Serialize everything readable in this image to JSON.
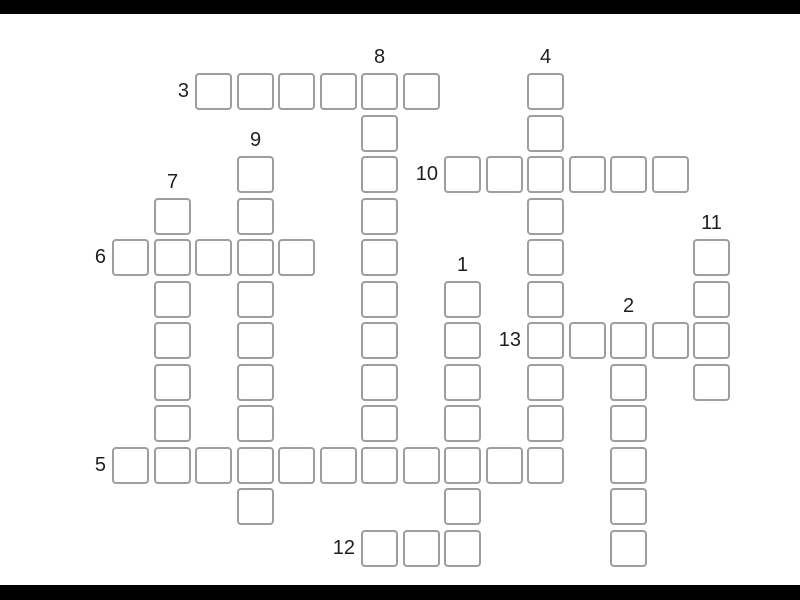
{
  "app": {
    "background_color": "#ffffff",
    "letterbox_color": "#000000"
  },
  "puzzle": {
    "type": "crossword-grid-empty",
    "cell_border_color": "#9e9e9e",
    "cell_fill_color": "#ffffff",
    "label_color": "#1f1f1f",
    "clue_numbers": [
      "1",
      "2",
      "3",
      "4",
      "5",
      "6",
      "7",
      "8",
      "9",
      "10",
      "11",
      "12",
      "13"
    ],
    "entries": [
      {
        "number": "3",
        "direction": "across",
        "row": 0,
        "col": 2,
        "length": 6
      },
      {
        "number": "8",
        "direction": "down",
        "row": 0,
        "col": 6,
        "length": 10
      },
      {
        "number": "4",
        "direction": "down",
        "row": 0,
        "col": 10,
        "length": 10
      },
      {
        "number": "9",
        "direction": "down",
        "row": 2,
        "col": 3,
        "length": 9
      },
      {
        "number": "10",
        "direction": "across",
        "row": 2,
        "col": 8,
        "length": 6
      },
      {
        "number": "7",
        "direction": "down",
        "row": 3,
        "col": 1,
        "length": 7
      },
      {
        "number": "6",
        "direction": "across",
        "row": 4,
        "col": 0,
        "length": 5
      },
      {
        "number": "11",
        "direction": "down",
        "row": 4,
        "col": 14,
        "length": 4
      },
      {
        "number": "1",
        "direction": "down",
        "row": 5,
        "col": 8,
        "length": 7
      },
      {
        "number": "13",
        "direction": "across",
        "row": 6,
        "col": 10,
        "length": 5
      },
      {
        "number": "2",
        "direction": "down",
        "row": 6,
        "col": 12,
        "length": 6
      },
      {
        "number": "5",
        "direction": "across",
        "row": 9,
        "col": 0,
        "length": 11
      },
      {
        "number": "12",
        "direction": "across",
        "row": 11,
        "col": 6,
        "length": 3
      }
    ]
  }
}
